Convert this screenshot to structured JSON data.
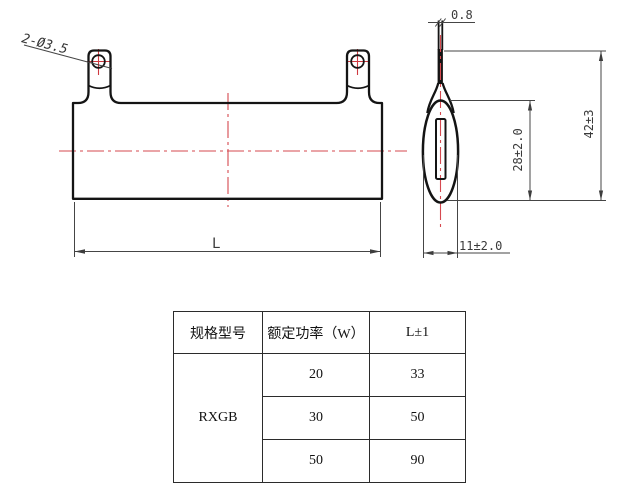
{
  "drawing": {
    "front_view": {
      "hole_label": "2-Ø3.5",
      "length_label": "L"
    },
    "side_view": {
      "tab_thickness": "0.8",
      "body_length": "28±2.0",
      "overall_length": "42±3",
      "width": "11±2.0"
    },
    "colors": {
      "outline": "#141414",
      "centerline": "#d6494f",
      "dimension": "#3d3d3d"
    }
  },
  "table": {
    "headers": [
      "规格型号",
      "额定功率（W）",
      "L±1"
    ],
    "model": "RXGB",
    "rows": [
      {
        "power": "20",
        "length": "33"
      },
      {
        "power": "30",
        "length": "50"
      },
      {
        "power": "50",
        "length": "90"
      }
    ]
  }
}
